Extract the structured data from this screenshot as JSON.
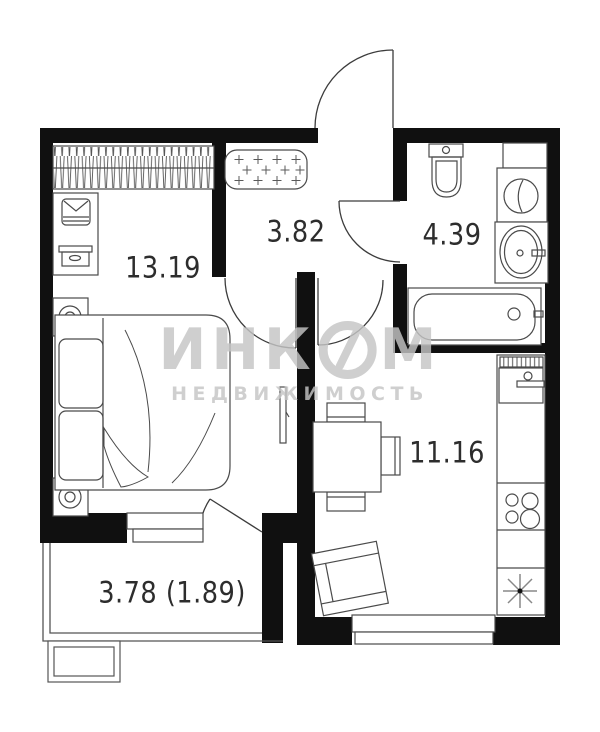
{
  "plan_title": "1-room apartment floor plan",
  "rooms": {
    "bedroom": {
      "name": "bedroom",
      "area": "13.19"
    },
    "hallway": {
      "name": "hallway",
      "area": "3.82"
    },
    "bathroom": {
      "name": "bathroom",
      "area": "4.39"
    },
    "kitchen_living": {
      "name": "kitchen-living",
      "area": "11.16"
    },
    "balcony": {
      "name": "balcony",
      "area": "3.78 (1.89)"
    }
  },
  "watermark": {
    "part1": "ИНК",
    "part2": "М",
    "line2": "НЕДВИЖИМОСТЬ"
  },
  "colors": {
    "background": "#ffffff",
    "wall": "#101010",
    "furniture_line": "#4a4a4a",
    "label_text": "#2d2d2d",
    "watermark": "#c5c5c5"
  }
}
